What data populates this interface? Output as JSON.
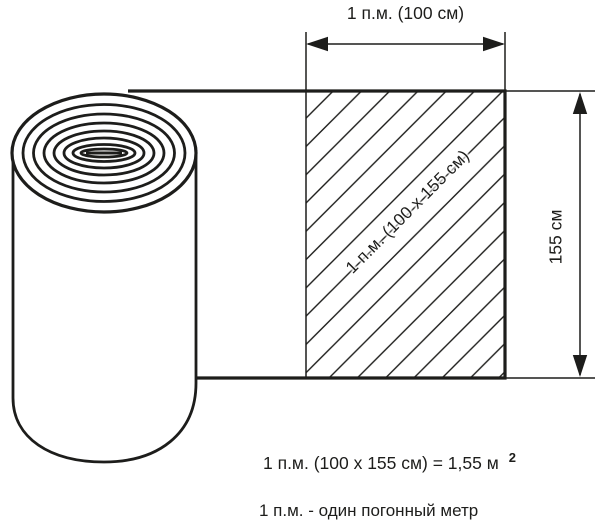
{
  "diagram": {
    "title_meaning": "linear meter of rolled material",
    "top_dimension": {
      "label": "1 п.м. (100 см)"
    },
    "hatched_area": {
      "label": "1 п.м. (100 x 155 см)"
    },
    "height_dimension": {
      "label": "155 см"
    },
    "formula": {
      "text": "1 п.м. (100 x 155 см) = 1,55 м",
      "superscript": "2"
    },
    "footnote": {
      "text": "1 п.м. - один погонный метр"
    },
    "colors": {
      "line": "#1d1d1b",
      "background": "#ffffff"
    }
  }
}
